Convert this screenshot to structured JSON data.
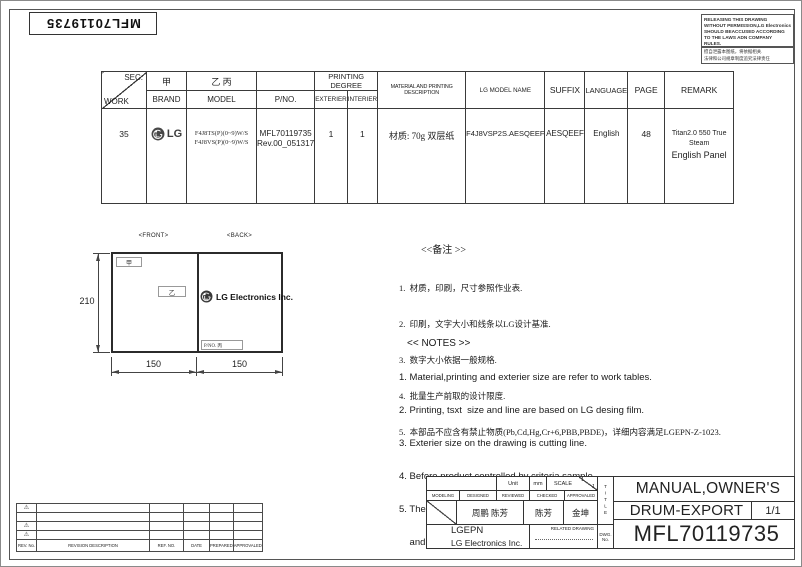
{
  "sheet": {
    "part_number_top": "MFL70119735",
    "warning_en": [
      "RELEASING THIS DRAWING",
      "WITHOUT PERMISSION,LG Electronics",
      "SHOULD BEACCUSED ACCORDING",
      "TO THE LAWS ADN COMPANY",
      "RULES."
    ],
    "warning_cn": [
      "擅自泄露本图纸，将依据相关.",
      "法律和公司规章制度追究法律责任"
    ]
  },
  "spec_table": {
    "headers": {
      "sec": "SEC.",
      "work": "WORK",
      "jia": "甲",
      "brand": "BRAND",
      "yi_bing": "乙 丙",
      "model": "MODEL",
      "pno": "P/NO.",
      "printing_degree": "PRINTING DEGREE",
      "exterier": "EXTERIER",
      "interier": "INTERIER",
      "material": "MATERIAL AND PRINTING DESCRIPTION",
      "lg_model_name": "LG MODEL NAME",
      "suffix": "SUFFIX",
      "language": "LANGUAGE",
      "page": "PAGE",
      "remark": "REMARK"
    },
    "row": {
      "work": "35",
      "brand": "LG",
      "model_line1": "F4J8TS(P)(0~9)W/S",
      "model_line2": "F4J8VS(P)(0~9)W/S",
      "pno_line1": "MFL70119735",
      "pno_line2": "Rev.00_051317",
      "exterier": "1",
      "interier": "1",
      "material": "材质: 70g 双层纸",
      "lg_model_name": "F4J8VSP2S.AESQEEF",
      "suffix": "AESQEEF",
      "language": "English",
      "page": "48",
      "remark_line1": "Titan2.0 550 True Steam",
      "remark_line2": "English Panel"
    }
  },
  "drawing": {
    "front_label": "<FRONT>",
    "back_label": "<BACK>",
    "jia": "甲",
    "yi": "乙",
    "pno_box": "P/NO. 丙",
    "logo_text": "LG Electronics Inc.",
    "dim_height": "210",
    "dim_width_front": "150",
    "dim_width_back": "150"
  },
  "notes_cn": {
    "title": "<<备注 >>",
    "lines": [
      "1.  材质，印刷，尺寸参照作业表.",
      "2.  印刷，文字大小和线条以LG设计基准.",
      "3.  数字大小依据一般规格.",
      "4.  批量生产前取的设计限度.",
      "5.  本部品不应含有禁止物质(Pb,Cd,Hg,Cr+6,PBB,PBDE)，详细内容满足LGEPN-Z-1023."
    ]
  },
  "notes_en": {
    "title": "<< NOTES >>",
    "lines": [
      "1. Material,printing and exterier size are refer to work tables.",
      "2. Printing, tsxt  size and line are based on LG desing film.",
      "3. Exterier size on the drawing is cutting line.",
      "4. Before product controlled by criteria sample.",
      "5. The part should not contain prohibited substances(Pb,Cd,Hg,Cr+6,PBB,PBDE)",
      "    and detailsShould comply with LGEPN-Z-1023."
    ]
  },
  "revision": {
    "marker": "⚠",
    "headers": {
      "rev_no": "REV. No.",
      "description": "REVISION DESCRIPTION",
      "ref_no": "REF. NO.",
      "date": "DATE",
      "prepared": "PREPARED",
      "approvaled": "APPROVALED"
    }
  },
  "title_block": {
    "unit_label": "Unit",
    "unit_value": "mm",
    "scale_label": "SCALE",
    "scale_num": "1",
    "scale_den": "1",
    "col_modeling": "MODELING",
    "col_designed": "DESIGNED",
    "col_reviewed": "REVIEWED",
    "col_checked": "CHECKED",
    "col_approvaled": "APPROVALED",
    "designed_by": "周鹏 陈芳",
    "checked_by": "陈芳",
    "approved_by": "金坤",
    "company_short": "LGEPN",
    "company_full": "LG Electronics Inc.",
    "related_drawing": "RELATED DRAWING",
    "title_label": "TITLE",
    "dwg_label_1": "DWG.",
    "dwg_label_2": "No.",
    "product_title": "MANUAL,OWNER'S",
    "product_subtitle": "DRUM-EXPORT",
    "sheet_count": "1/1",
    "drawing_number": "MFL70119735"
  }
}
